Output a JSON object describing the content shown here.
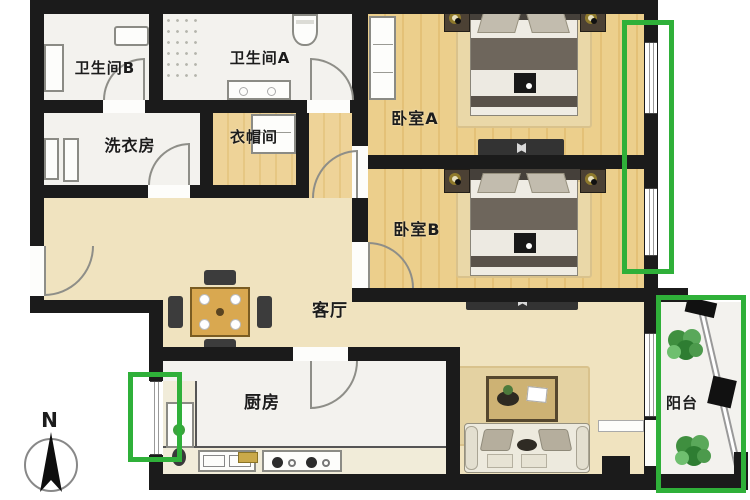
{
  "title": "两室两卫户型图",
  "rooms": {
    "bathroom_b": {
      "label": "卫生间B"
    },
    "bathroom_a": {
      "label": "卫生间A"
    },
    "laundry": {
      "label": "洗衣房"
    },
    "cloakroom": {
      "label": "衣帽间"
    },
    "bedroom_a": {
      "label": "卧室A"
    },
    "bedroom_b": {
      "label": "卧室B"
    },
    "living": {
      "label": "客厅"
    },
    "kitchen": {
      "label": "厨房"
    },
    "balcony": {
      "label": "阳台"
    }
  },
  "compass": {
    "north_label": "N"
  },
  "icons": [
    "compass-icon",
    "plant-icon",
    "bed",
    "sofa",
    "coffee-table",
    "dining-table",
    "tv-console",
    "toilet-icon",
    "sink-icon",
    "stove-icon",
    "fridge",
    "washer",
    "wardrobe",
    "door-arc",
    "window"
  ],
  "colors": {
    "wall": "#1b1b1b",
    "highlight_green": "#2fb039",
    "wood_floor": "#e9cd8a",
    "living_floor": "#f0e3bf",
    "tile_floor": "#f3f2ee",
    "lamp_gold": "#8f7a2c"
  }
}
